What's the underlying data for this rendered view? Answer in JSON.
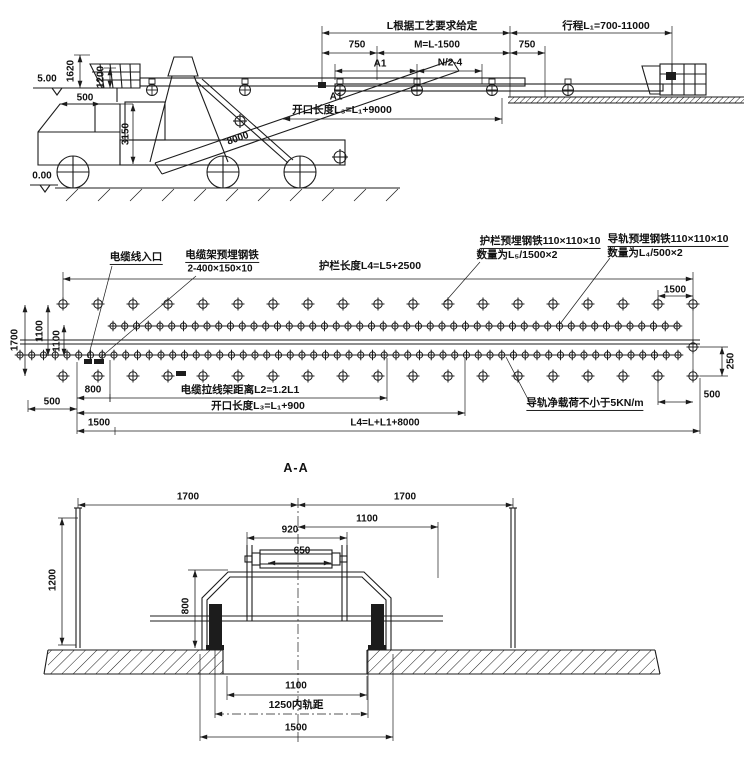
{
  "top_view": {
    "dim_l_spec": "L根据工艺要求给定",
    "dim_travel": "行程L₁=700-11000",
    "dim_750_left": "750",
    "dim_m": "M=L-1500",
    "dim_750_right": "750",
    "dim_a1_upper": "A1",
    "dim_n": "N/2-4",
    "dim_a1_lower": "A1",
    "dim_opening": "开口长度L₃=L₁+9000",
    "elev_top": "5.00",
    "dim_1620": "1620",
    "dim_1200": "1200",
    "dim_500": "500",
    "dim_3150": "3150",
    "dim_8000": "8000",
    "elev_ground": "0.00"
  },
  "plan_view": {
    "label_cable_entry": "电缆线入口",
    "label_cable_rack_1": "电缆架预埋钢铁",
    "label_cable_rack_2": "2-400×150×10",
    "label_guardrail_length": "护栏长度L4=L5+2500",
    "label_guardrail_steel_1": "护栏预埋钢铁110×110×10",
    "label_guardrail_steel_2": "数量为L₅/1500×2",
    "label_rail_steel_1": "导轨预埋钢铁110×110×10",
    "label_rail_steel_2": "数量为L₄/500×2",
    "dim_1500_top": "1500",
    "dim_1700": "1700",
    "dim_1100_outer": "1100",
    "dim_1100_inner": "1100",
    "dim_800": "800",
    "label_cable_stay": "电缆拉线架距离L2=1.2L1",
    "dim_500_left": "500",
    "label_opening": "开口长度L₃=L₁+900",
    "dim_1500_left": "1500",
    "label_l4": "L4=L+L1+8000",
    "label_rail_load": "导轨净载荷不小于5KN/m",
    "dim_250": "250",
    "dim_500_right": "500"
  },
  "section_view": {
    "title": "A-A",
    "dim_1700_left": "1700",
    "dim_1700_right": "1700",
    "dim_1100_top": "1100",
    "dim_920": "920",
    "dim_650": "650",
    "dim_800": "800",
    "dim_1200": "1200",
    "dim_1100_bottom": "1100",
    "dim_gauge": "1250内轨距",
    "dim_1500": "1500"
  }
}
